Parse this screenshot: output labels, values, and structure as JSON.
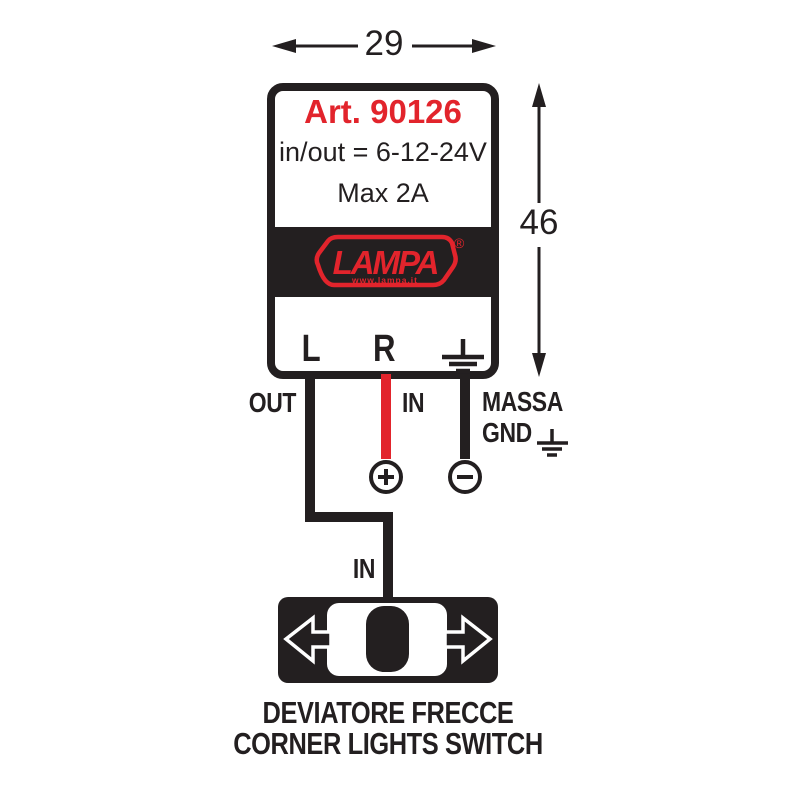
{
  "dimensions": {
    "width_mm": "29",
    "height_mm": "46"
  },
  "device": {
    "article": "Art. 90126",
    "voltage_spec": "in/out = 6-12-24V",
    "current_spec": "Max 2A",
    "brand": {
      "name": "LAMPA",
      "website": "www.lampa.it",
      "registered_mark": "®"
    },
    "terminal_left": "L",
    "terminal_right": "R"
  },
  "wiring": {
    "out_label": "OUT",
    "in_label": "IN",
    "ground_label_line1": "MASSA",
    "ground_label_line2": "GND",
    "positive_symbol": "+",
    "negative_symbol": "−",
    "switch_input_label": "IN"
  },
  "switch_caption": {
    "line1": "DEVIATORE FRECCE",
    "line2": "CORNER LIGHTS SWITCH"
  },
  "colors": {
    "accent_red": "#e2242c",
    "ink": "#231f20"
  }
}
